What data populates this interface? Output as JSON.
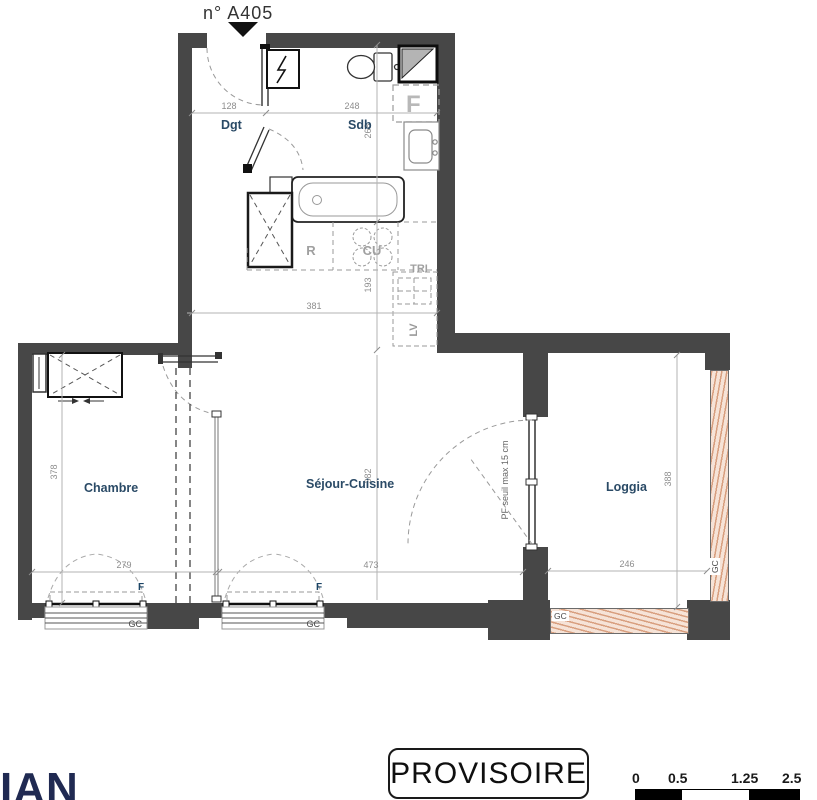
{
  "plan": {
    "unit": "n° A405",
    "rooms": {
      "dgt": "Dgt",
      "sdb": "Sdb",
      "chambre": "Chambre",
      "sejour": "Séjour-Cuisine",
      "loggia": "Loggia"
    },
    "kitchen": {
      "fridge": "R",
      "cooktop": "CU",
      "sorting": "TRI",
      "dishwasher": "LV"
    },
    "labels": {
      "window": "F",
      "reserved": "F",
      "guardrail": "GC",
      "pf_note": "PF seuil max 15 cm"
    },
    "dims": {
      "dgt_w": "128",
      "sdb_w": "248",
      "sdb_d": "268",
      "kitchen_d": "193",
      "kitchen_w": "381",
      "chambre_d": "378",
      "chambre_w": "279",
      "sejour_d": "382",
      "sejour_w": "473",
      "loggia_w": "246",
      "loggia_d": "388"
    }
  },
  "stamp": "PROVISOIRE",
  "logo": "IAN",
  "scalebar": {
    "t0": "0",
    "t1": "0.5",
    "t2": "1.25",
    "t3": "2.5"
  },
  "colors": {
    "wall": "#474747",
    "room_label": "#2a4a66",
    "dim": "#8d8d8d",
    "hatch": "#e4b394",
    "logo": "#202a52"
  }
}
